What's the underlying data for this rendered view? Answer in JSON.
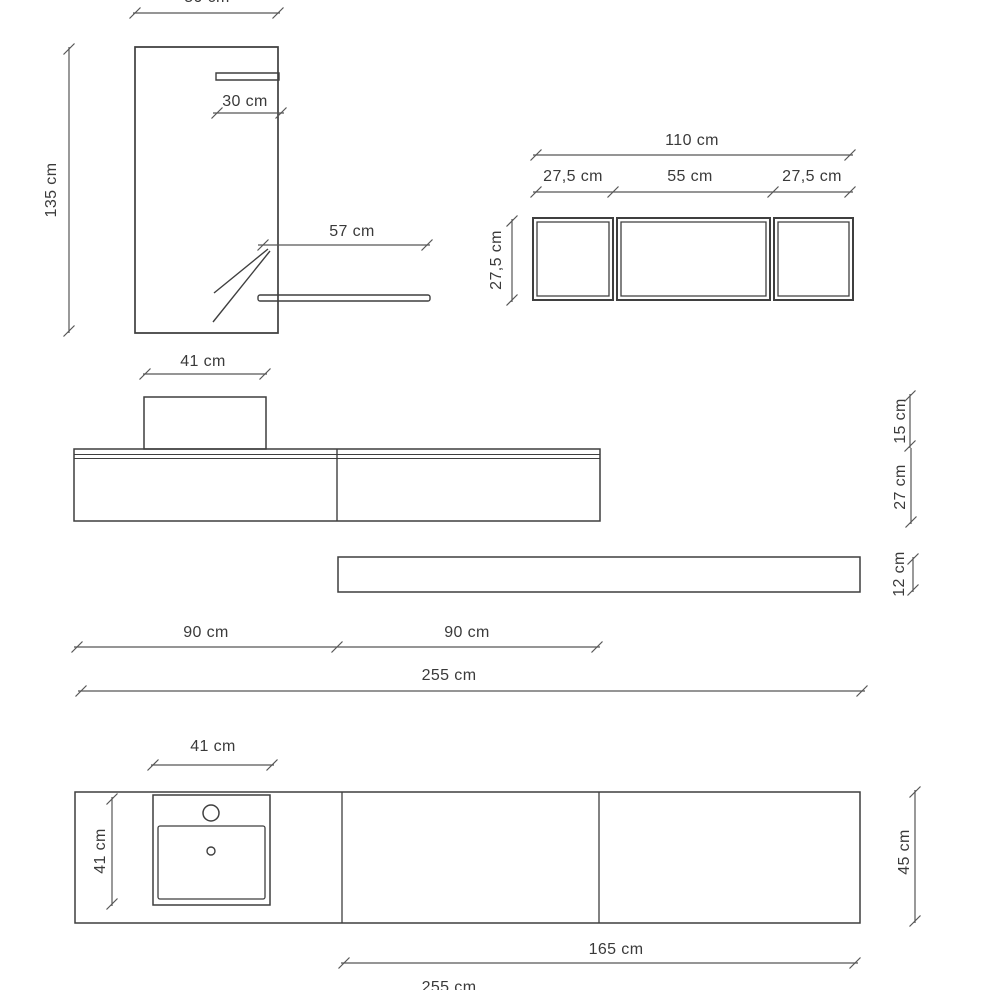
{
  "drawing_title": "bathroom-vanity-technical-drawing",
  "colors": {
    "line": "#3f3f3f",
    "dim_line": "#565656",
    "text": "#3a3a3a",
    "background": "#ffffff"
  },
  "views": {
    "mirror": {
      "width": "50 cm",
      "bar_width": "30 cm",
      "height": "135 cm",
      "shelf_length": "57 cm"
    },
    "wall_unit": {
      "total_width": "110 cm",
      "left_width": "27,5 cm",
      "center_width": "55 cm",
      "right_width": "27,5 cm",
      "height": "27,5 cm"
    },
    "vanity_front": {
      "basin_width": "41 cm",
      "basin_height": "15 cm",
      "cabinet_height": "27 cm",
      "shelf_height": "12 cm",
      "module_left_width": "90 cm",
      "module_right_width": "90 cm",
      "total_width": "255 cm"
    },
    "vanity_plan": {
      "basin_width": "41 cm",
      "basin_depth": "41 cm",
      "counter_depth": "45 cm",
      "right_section_width": "165 cm",
      "total_width": "255 cm"
    }
  }
}
